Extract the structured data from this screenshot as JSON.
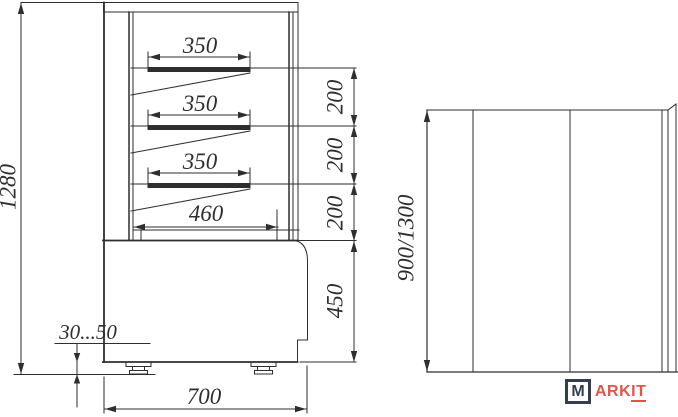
{
  "drawing": {
    "title": "Display case dimensional drawing",
    "side_view": {
      "overall_height": "1280",
      "shelf1_width": "350",
      "shelf2_width": "350",
      "shelf3_width": "350",
      "shelf_gap1": "200",
      "shelf_gap2": "200",
      "shelf_gap3": "200",
      "bottom_deck_width": "460",
      "base_height": "450",
      "feet_adjust_range": "30...50",
      "overall_depth": "700"
    },
    "front_view": {
      "height_options": "900/1300"
    },
    "colors": {
      "line": "#2e2e2e",
      "logo_navy": "#333e4e",
      "logo_red": "#e0544a"
    }
  },
  "logo": {
    "initial": "M",
    "name_part1": "ARK",
    "name_part2": "IT"
  }
}
